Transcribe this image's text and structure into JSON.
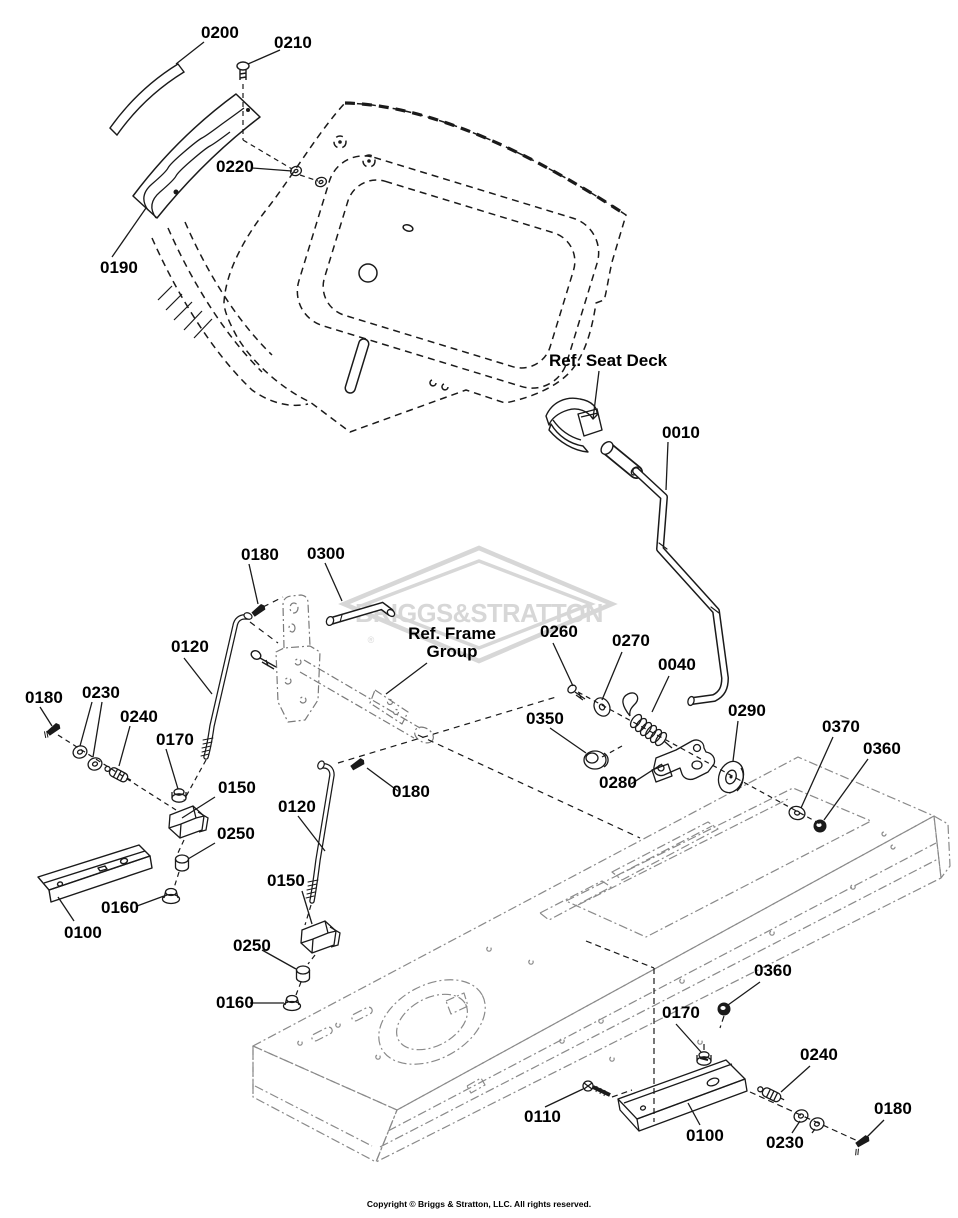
{
  "watermark": {
    "text": "BRIGGS&STRATTON",
    "registered": "®",
    "color": "#d7d7d7"
  },
  "copyright": {
    "text": "Copyright © Briggs & Stratton, LLC. All rights reserved."
  },
  "colors": {
    "ink": "#1a1a1a",
    "frame_line": "#8a8a8a",
    "background": "#ffffff"
  },
  "part_labels": [
    {
      "text": "0200",
      "x": 201,
      "y": 24
    },
    {
      "text": "0210",
      "x": 274,
      "y": 34
    },
    {
      "text": "0220",
      "x": 216,
      "y": 158
    },
    {
      "text": "0190",
      "x": 100,
      "y": 259
    },
    {
      "text": "Ref. Seat Deck",
      "x": 549,
      "y": 352
    },
    {
      "text": "0010",
      "x": 662,
      "y": 424
    },
    {
      "text": "0180",
      "x": 241,
      "y": 546
    },
    {
      "text": "0300",
      "x": 307,
      "y": 545
    },
    {
      "text": "Ref. Frame\nGroup",
      "x": 396,
      "y": 625,
      "center": true,
      "w": 112
    },
    {
      "text": "0260",
      "x": 540,
      "y": 623
    },
    {
      "text": "0270",
      "x": 612,
      "y": 632
    },
    {
      "text": "0040",
      "x": 658,
      "y": 656
    },
    {
      "text": "0120",
      "x": 171,
      "y": 638
    },
    {
      "text": "0180",
      "x": 25,
      "y": 689
    },
    {
      "text": "0230",
      "x": 82,
      "y": 684
    },
    {
      "text": "0240",
      "x": 120,
      "y": 708
    },
    {
      "text": "0170",
      "x": 156,
      "y": 731
    },
    {
      "text": "0150",
      "x": 218,
      "y": 779
    },
    {
      "text": "0250",
      "x": 217,
      "y": 825
    },
    {
      "text": "0120",
      "x": 278,
      "y": 798
    },
    {
      "text": "0180",
      "x": 392,
      "y": 783
    },
    {
      "text": "0350",
      "x": 526,
      "y": 710
    },
    {
      "text": "0290",
      "x": 728,
      "y": 702
    },
    {
      "text": "0370",
      "x": 822,
      "y": 718
    },
    {
      "text": "0360",
      "x": 863,
      "y": 740
    },
    {
      "text": "0280",
      "x": 599,
      "y": 774
    },
    {
      "text": "0160",
      "x": 101,
      "y": 899
    },
    {
      "text": "0100",
      "x": 64,
      "y": 924
    },
    {
      "text": "0150",
      "x": 267,
      "y": 872
    },
    {
      "text": "0250",
      "x": 233,
      "y": 937
    },
    {
      "text": "0160",
      "x": 216,
      "y": 994
    },
    {
      "text": "0360",
      "x": 754,
      "y": 962
    },
    {
      "text": "0170",
      "x": 662,
      "y": 1004
    },
    {
      "text": "0110",
      "x": 524,
      "y": 1108
    },
    {
      "text": "0100",
      "x": 686,
      "y": 1127
    },
    {
      "text": "0240",
      "x": 800,
      "y": 1046
    },
    {
      "text": "0230",
      "x": 766,
      "y": 1134
    },
    {
      "text": "0180",
      "x": 874,
      "y": 1100
    }
  ]
}
